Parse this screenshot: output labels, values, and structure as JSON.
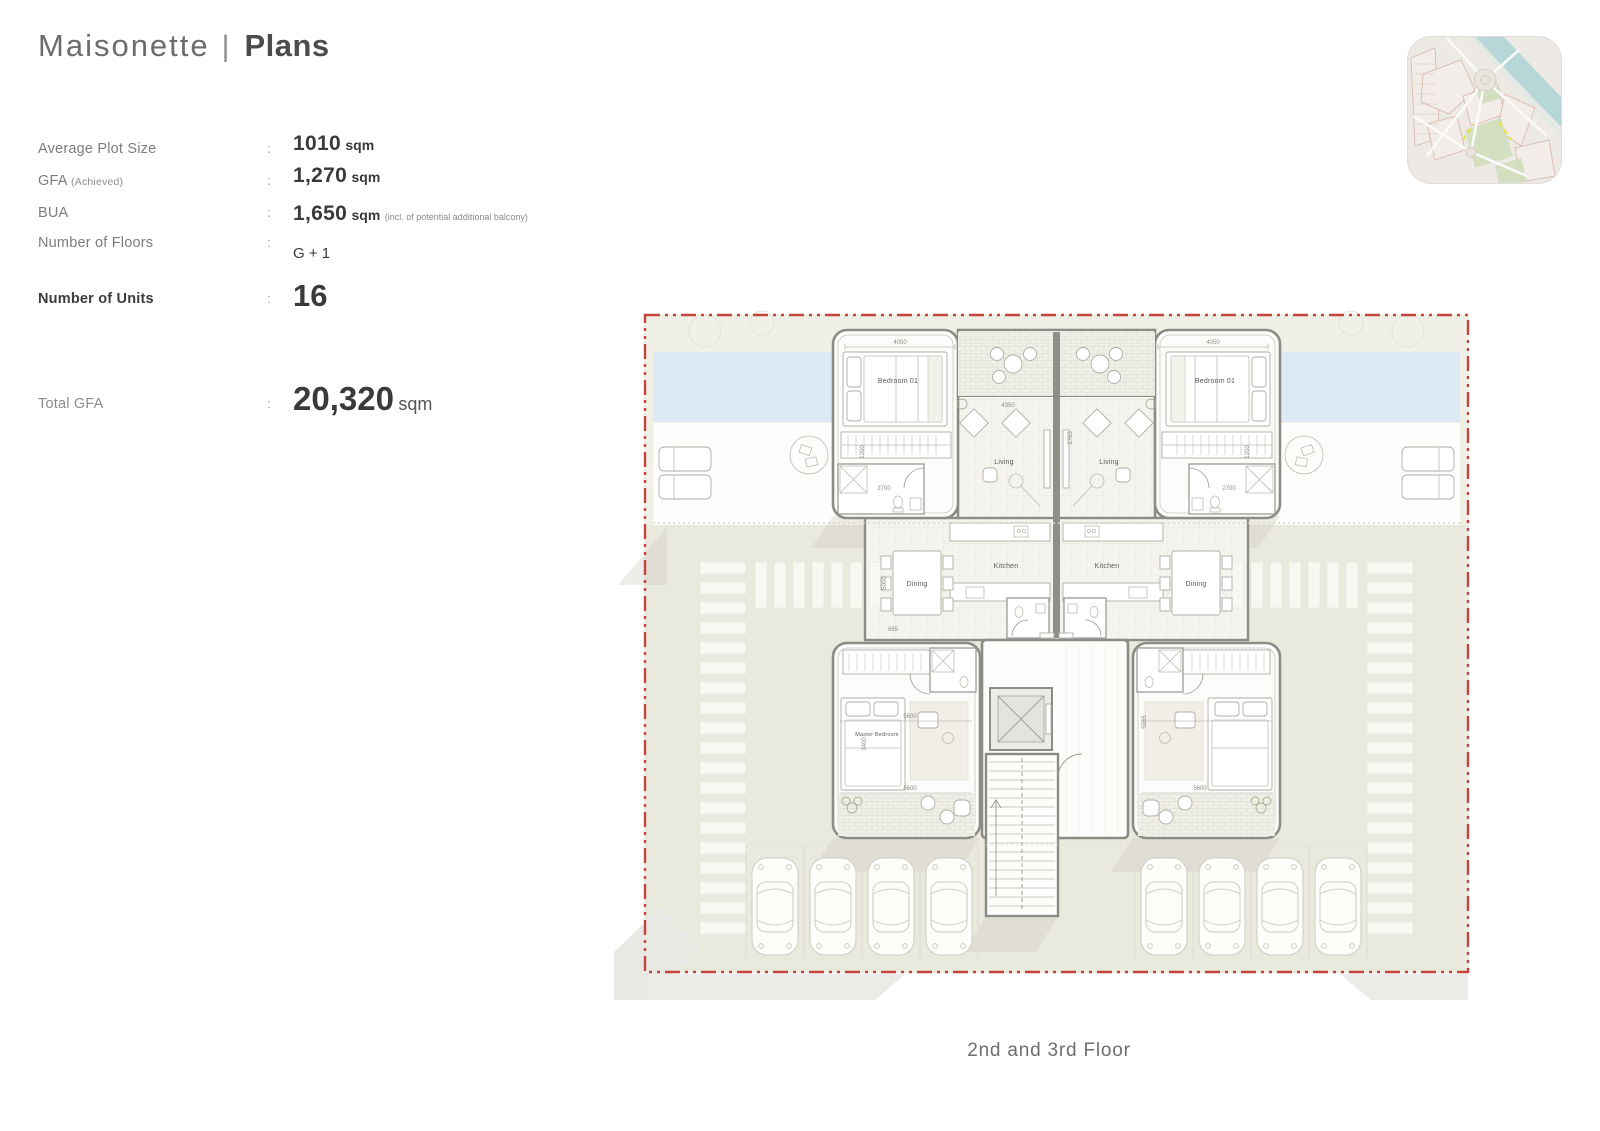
{
  "title": {
    "left": "Maisonette",
    "separator": "|",
    "right": "Plans"
  },
  "specs_colon": ":",
  "specs": [
    {
      "label": "Average Plot Size",
      "value": "1010",
      "unit": "sqm"
    },
    {
      "label": "GFA",
      "label_note": "(Achieved)",
      "value": "1,270",
      "unit": "sqm"
    },
    {
      "label": "BUA",
      "value": "1,650",
      "unit": "sqm",
      "value_note": "(incl. of potential additional balcony)"
    },
    {
      "label": "Number of Floors",
      "value": "G + 1"
    },
    {
      "label": "Number of Units",
      "value": "16"
    },
    {
      "label": "Total GFA",
      "value": "20,320",
      "unit": "sqm"
    }
  ],
  "plan": {
    "caption": "2nd and 3rd Floor",
    "room_labels": [
      "Bedroom 01",
      "Bedroom 01",
      "Living",
      "Living",
      "Kitchen",
      "Kitchen",
      "Dining",
      "Dining",
      "Master Bedroom"
    ],
    "dimensions": [
      "4050",
      "4050",
      "4350",
      "3765",
      "1200",
      "1200",
      "2700",
      "2700",
      "5000",
      "665",
      "5600",
      "5600",
      "5600",
      "3400",
      "5965"
    ],
    "colors": {
      "boundary": "#c5453d",
      "pool": "#ddeaf6",
      "site_upper": "#f1f0e7",
      "site_lower": "#eae9dd",
      "deck": "#fdfdfb",
      "wall": "#8c8c86"
    }
  },
  "minimap": {
    "colors": {
      "land": "#edeae6",
      "river": "#b7d6d8",
      "park": "#cfdcba",
      "block_outline": "#d9b3a8",
      "road": "#fbfaf8",
      "accent_dash": "#e7e44e"
    }
  }
}
